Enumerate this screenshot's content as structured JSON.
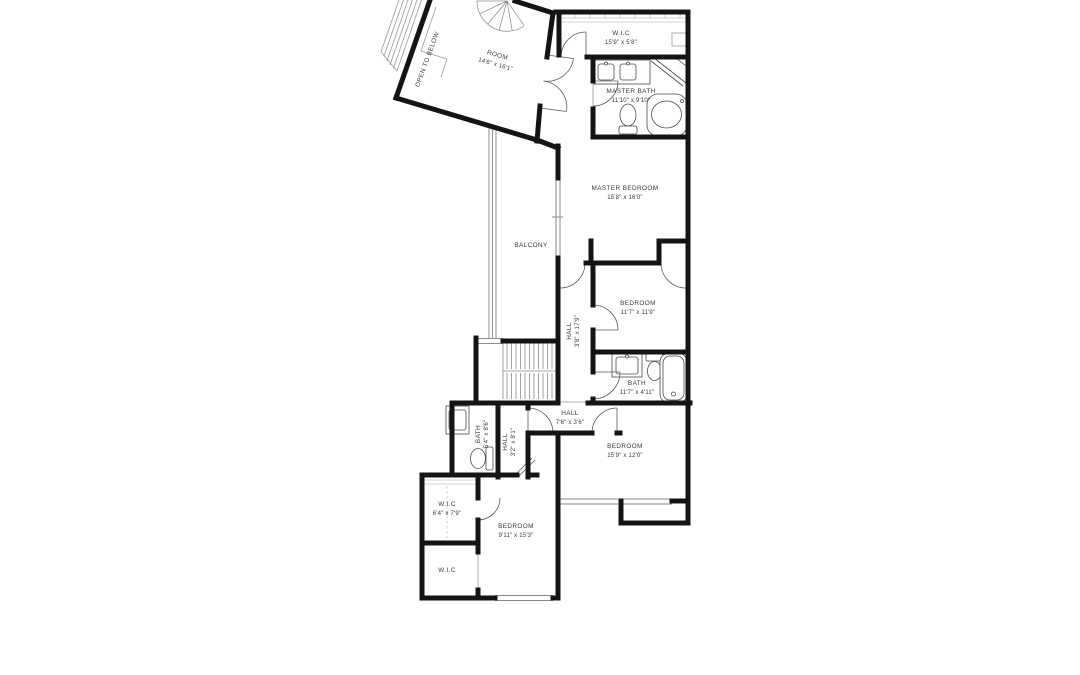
{
  "plan": {
    "type": "floor-plan",
    "floor": "upper",
    "colors": {
      "wall": "#141414",
      "label": "#3a3a3a",
      "thin_line": "#8a8a8a",
      "background": "#ffffff"
    },
    "rooms": [
      {
        "id": "room",
        "name": "ROOM",
        "dims": "14'6\" x 16'1\""
      },
      {
        "id": "open-to-below",
        "name": "OPEN TO BELOW",
        "dims": ""
      },
      {
        "id": "wic-top",
        "name": "W.I.C",
        "dims": "15'9\" x 5'8\""
      },
      {
        "id": "master-bath",
        "name": "MASTER BATH",
        "dims": "11'10\" x 9'10\""
      },
      {
        "id": "master-bedroom",
        "name": "MASTER BEDROOM",
        "dims": "15'8\" x 16'0\""
      },
      {
        "id": "balcony",
        "name": "BALCONY",
        "dims": ""
      },
      {
        "id": "hall-long",
        "name": "HALL",
        "dims": "3'8\" x 17'9\""
      },
      {
        "id": "bedroom-2",
        "name": "BEDROOM",
        "dims": "11'7\" x 11'9\""
      },
      {
        "id": "bath-2",
        "name": "BATH",
        "dims": "11'7\" x 4'11\""
      },
      {
        "id": "hall-mid",
        "name": "HALL",
        "dims": "7'6\" x 3'6\""
      },
      {
        "id": "bath-3",
        "name": "BATH",
        "dims": "5'4\" x 8'6\""
      },
      {
        "id": "hall-small",
        "name": "HALL",
        "dims": "3'2\" x 8'1\""
      },
      {
        "id": "bedroom-3",
        "name": "BEDROOM",
        "dims": "15'9\" x 12'0\""
      },
      {
        "id": "wic-mid",
        "name": "W.I.C",
        "dims": "6'4\" x 7'9\""
      },
      {
        "id": "bedroom-4",
        "name": "BEDROOM",
        "dims": "9'11\" x 15'3\""
      },
      {
        "id": "wic-bottom",
        "name": "W.I.C",
        "dims": ""
      }
    ],
    "features": [
      "spiral-staircase",
      "u-staircase",
      "balcony-railing",
      "double-doors",
      "windows",
      "bathtub",
      "corner-tub",
      "shower",
      "toilets",
      "sink-vanities",
      "closet-shelving"
    ]
  }
}
